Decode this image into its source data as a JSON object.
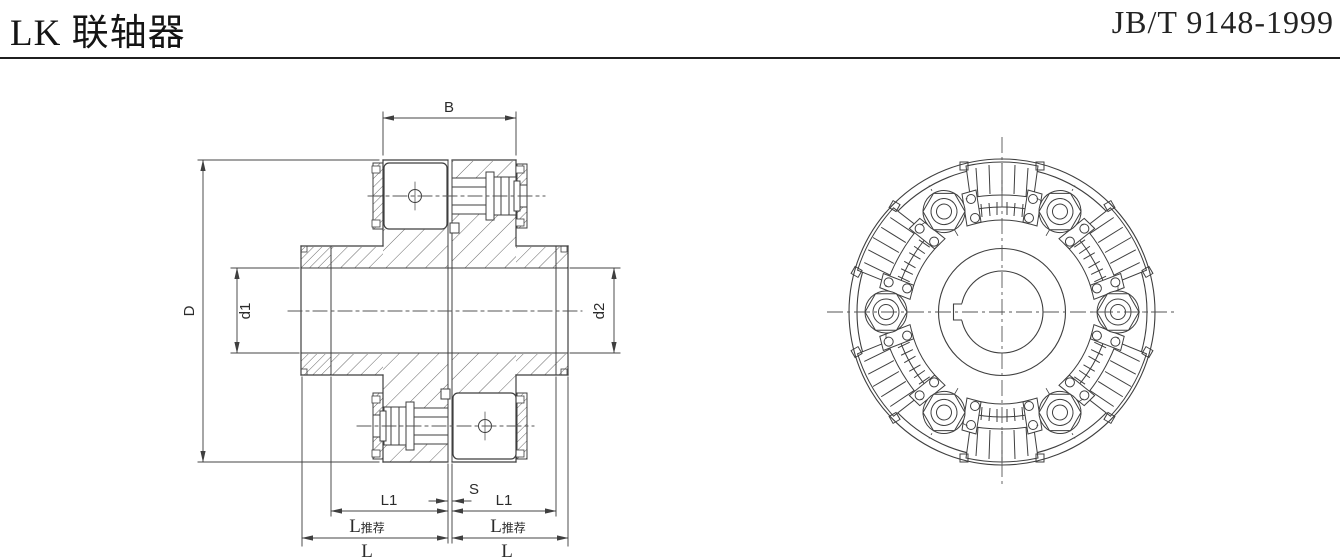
{
  "header": {
    "title": "LK 联轴器",
    "standard": "JB/T 9148-1999"
  },
  "section_view": {
    "dims": {
      "B": "B",
      "D": "D",
      "d1": "d1",
      "d2": "d2",
      "L1": "L1",
      "S": "S",
      "L": "L",
      "rec": "推荐"
    }
  },
  "front_view": {
    "pin_assemblies": 6,
    "block_assemblies": 6
  },
  "colors": {
    "line": "#3f3f3f",
    "text": "#2b2b2b",
    "header_text": "#141414"
  }
}
